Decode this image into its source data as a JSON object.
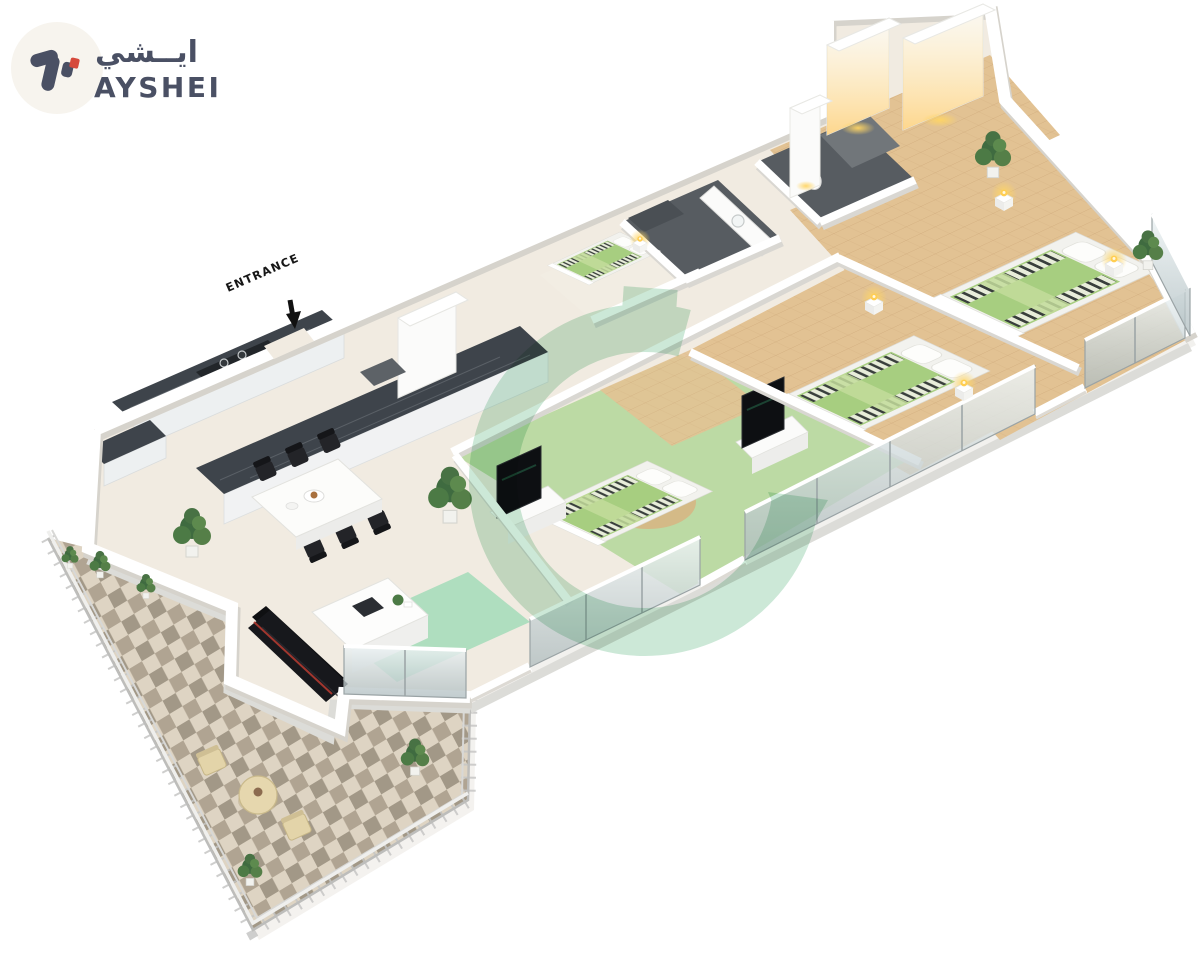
{
  "logo": {
    "arabic_name": "ايــشي",
    "latin_name": "AYSHEI",
    "mark": "ayshei-monogram",
    "text_color": "#4a5064",
    "accent_color": "#d6493c",
    "badge_color": "#f7f4ee"
  },
  "annotations": {
    "entrance_label": "ENTRANCE"
  },
  "palette": {
    "background": "#ffffff",
    "floor_beige": "#f1ebe1",
    "wood_floor": "#e2c293",
    "bed_green": "#a7ce80",
    "bedroom_floor_green": "#bcdaa4",
    "counter_dark": "#3e444b",
    "watermark_green": "#a9d9bd",
    "rug_green": "#a9dcbc",
    "balcony_tile_light": "#ded4c3",
    "balcony_tile_dark": "#9b9180",
    "glass_blue": "#cfdcdf",
    "glow_yellow": "#ffd564",
    "sofa_black": "#17181c",
    "wall_white": "#ffffff",
    "wall_shadow": "#d6d3cc",
    "bath_tile_dark": "#575c61"
  },
  "scene": {
    "type": "isometric-3d-floor-plan-render",
    "rooms_visible": [
      "kitchen",
      "dining-area",
      "living-area",
      "balcony-terrace",
      "bedroom-1",
      "bedroom-2",
      "bedroom-3",
      "maid-room",
      "bathroom-1",
      "bathroom-2",
      "walk-in-wardrobe",
      "entrance-hallway"
    ]
  }
}
